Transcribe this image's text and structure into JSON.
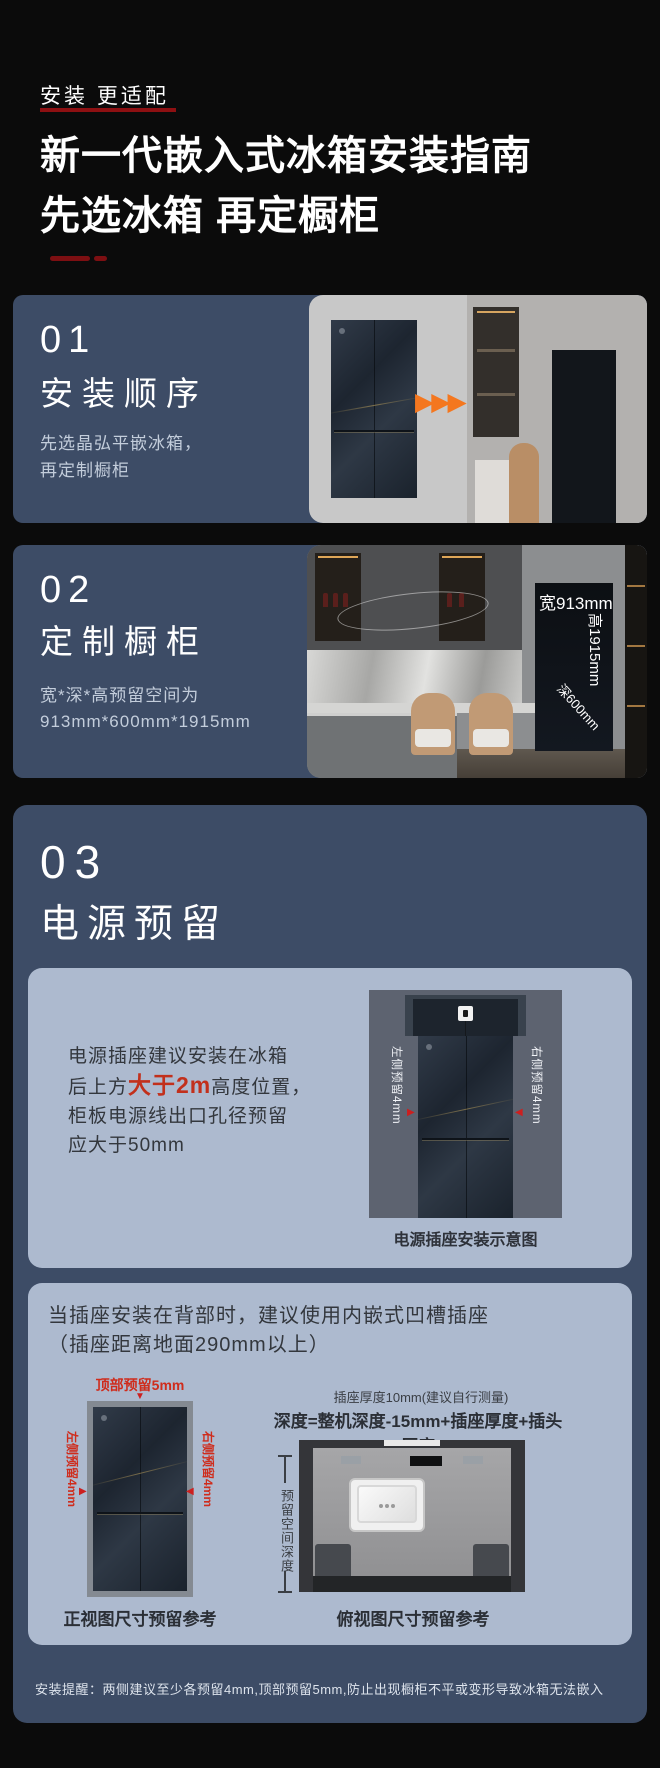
{
  "colors": {
    "background": "#0b0b0b",
    "panel_blue": "#3d4c66",
    "card_light": "#adbacf",
    "accent_red": "#c2301c",
    "marker_red": "#cc1f1f",
    "dark_red_underline": "#8e1012",
    "arrow_orange": "#f4771f"
  },
  "icons": {
    "arrows_right": "▶▶▶",
    "marker_down": "▼",
    "marker_right": "▶",
    "marker_left": "◀"
  },
  "header": {
    "tagline": "安装 更适配",
    "title_line1": "新一代嵌入式冰箱安装指南",
    "title_line2": "先选冰箱 再定橱柜"
  },
  "step1": {
    "number": "01",
    "title": "安装顺序",
    "desc1": "先选晶弘平嵌冰箱，",
    "desc2": "再定制橱柜"
  },
  "step2": {
    "number": "02",
    "title": "定制橱柜",
    "desc1": "宽*深*高预留空间为",
    "desc2": "913mm*600mm*1915mm",
    "photo_labels": {
      "width": "宽913mm",
      "height": "高1915mm",
      "depth": "深600mm"
    }
  },
  "step3": {
    "number": "03",
    "title": "电源预留",
    "socket_card": {
      "line1": "电源插座建议安装在冰箱",
      "line2_pre": "后上方",
      "line2_red": "大于2m",
      "line2_post": "高度位置，",
      "line3": "柜板电源线出口孔径预留",
      "line4": "应大于50mm",
      "label_left": "左侧预留4mm",
      "label_right": "右侧预留4mm",
      "caption": "电源插座安装示意图"
    },
    "recessed_card": {
      "title1": "当插座安装在背部时，建议使用内嵌式凹槽插座",
      "title2": "（插座距离地面290mm以上）",
      "front_view": {
        "top_label": "顶部预留5mm",
        "left_label": "左侧预留4mm",
        "right_label": "右侧预留4mm",
        "caption": "正视图尺寸预留参考"
      },
      "top_view": {
        "note": "插座厚度10mm(建议自行测量)",
        "formula": "深度=整机深度-15mm+插座厚度+插头厚度",
        "depth_label": "预留空间深度",
        "caption": "俯视图尺寸预留参考"
      }
    },
    "footnote": "安装提醒：两侧建议至少各预留4mm,顶部预留5mm,防止出现橱柜不平或变形导致冰箱无法嵌入"
  }
}
